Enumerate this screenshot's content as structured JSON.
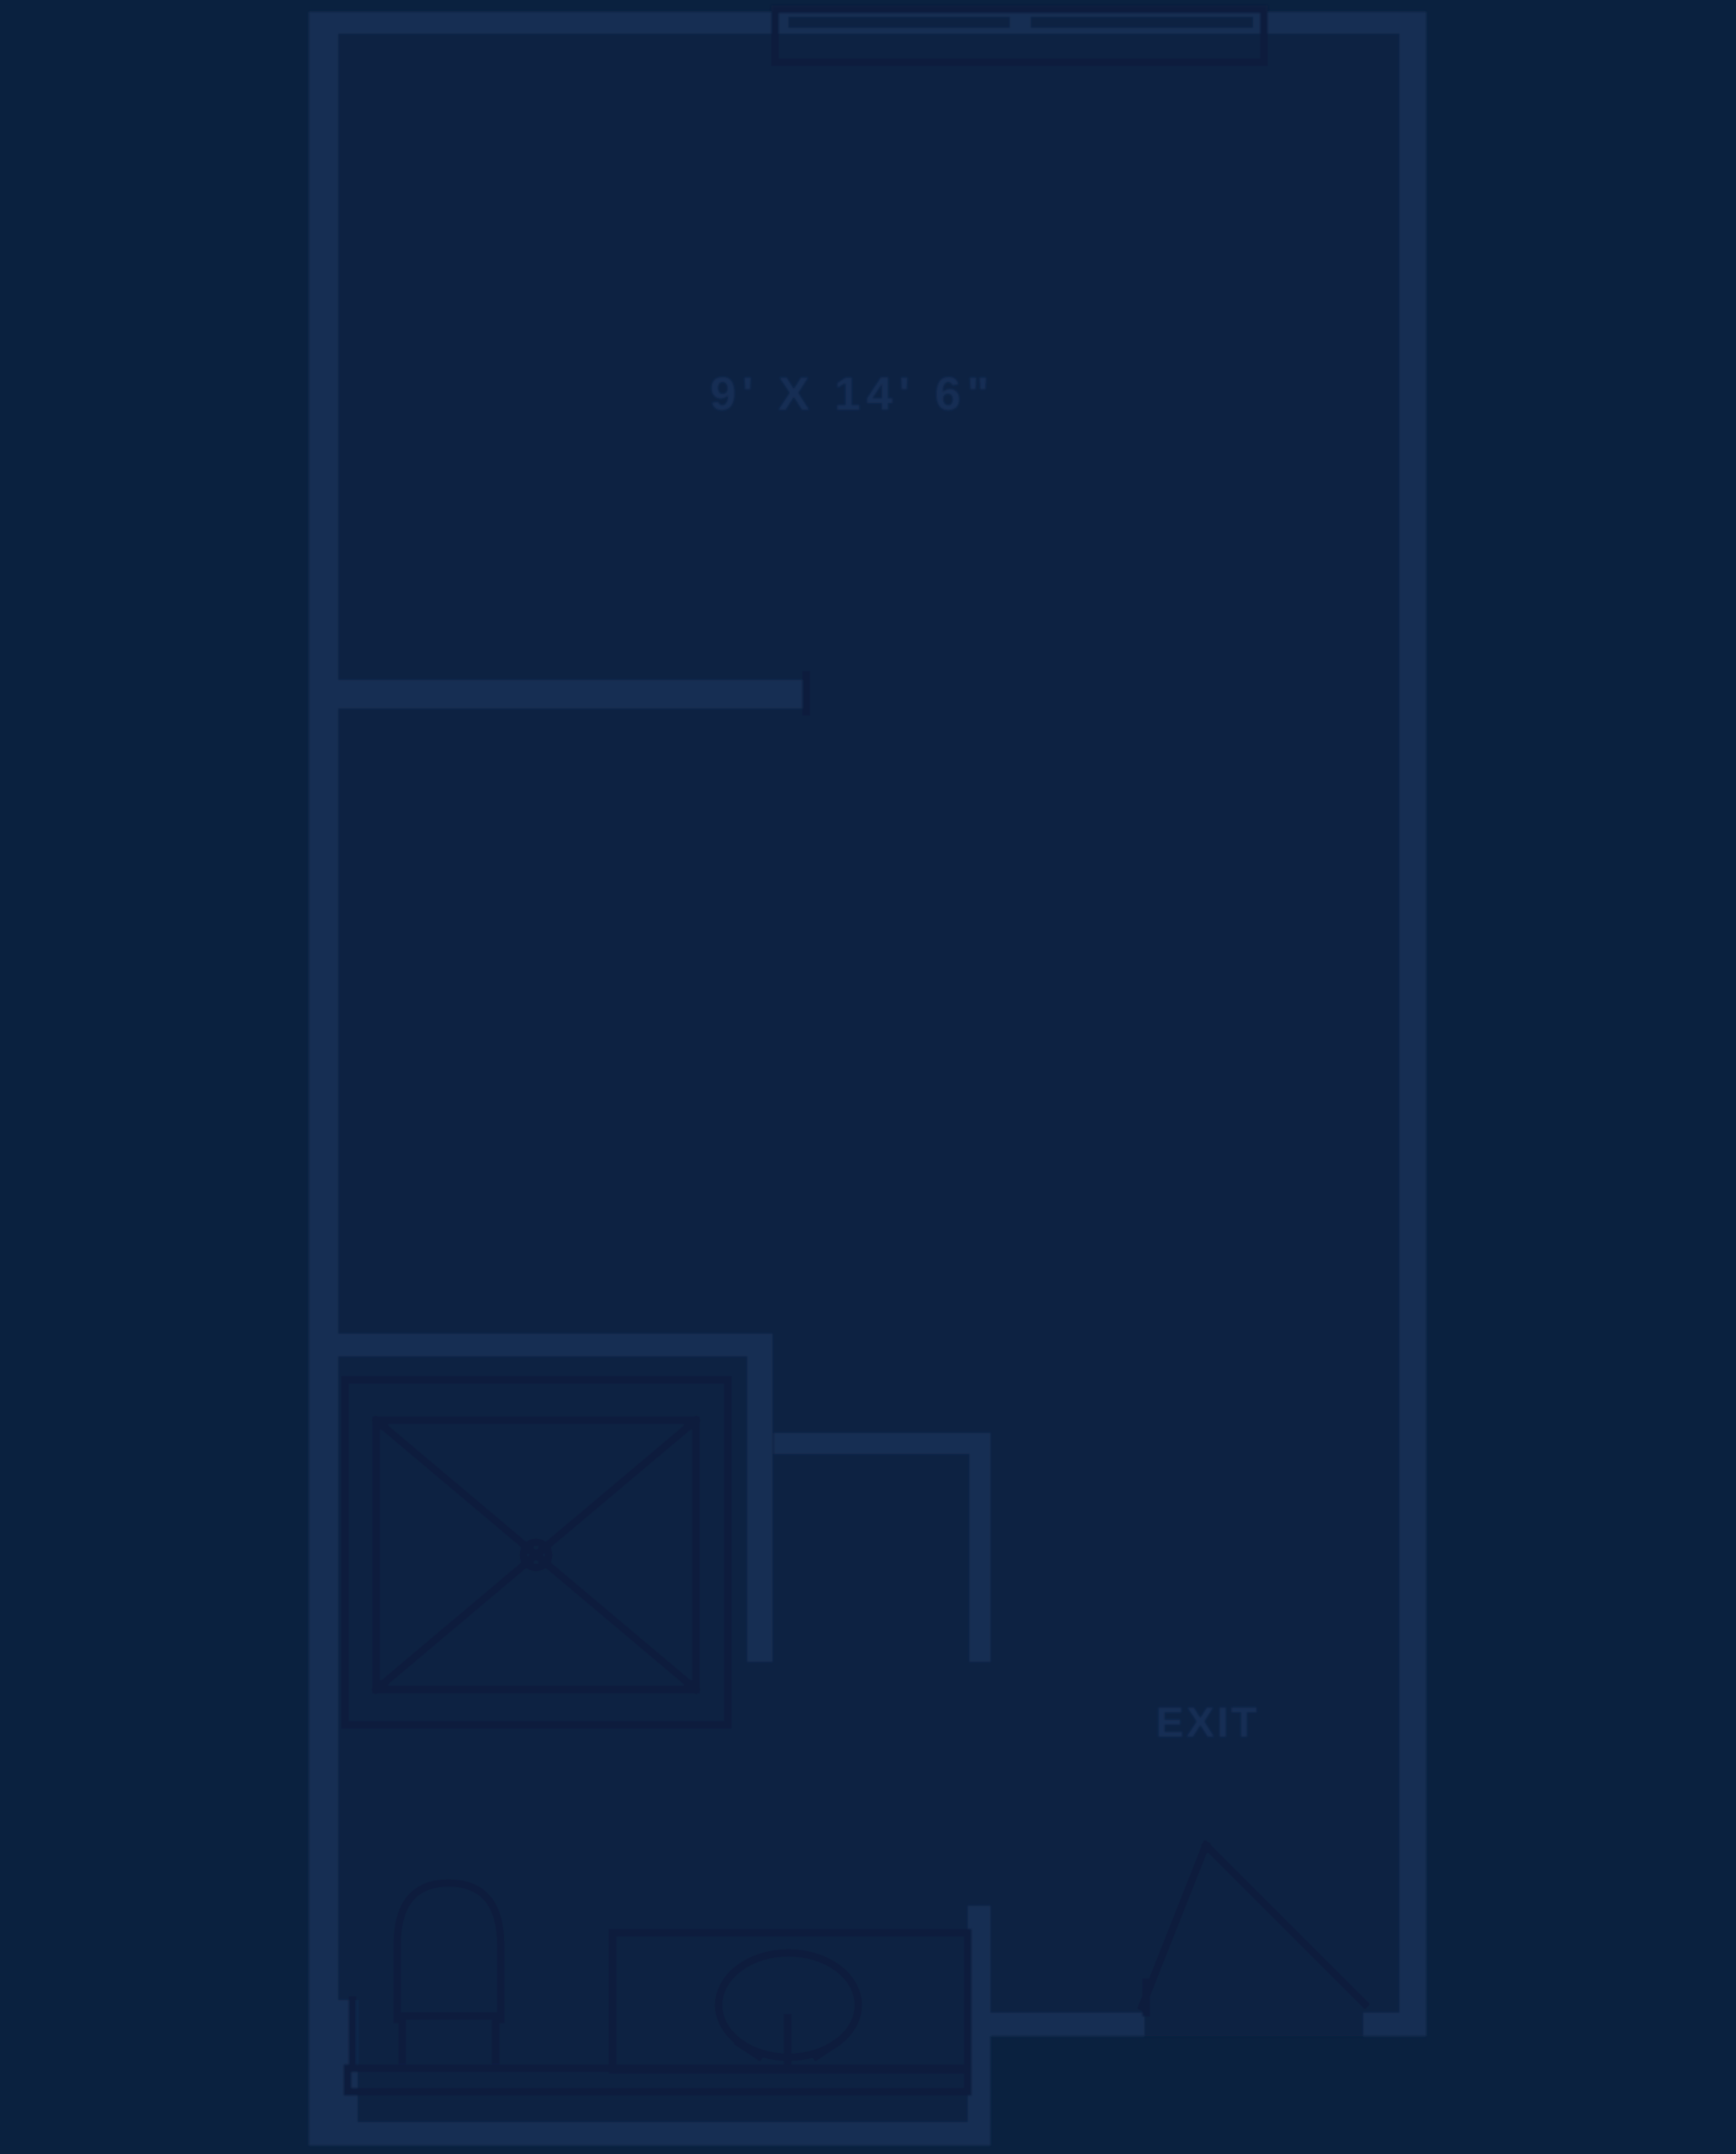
{
  "labels": {
    "room_dimension": "9' X 14' 6\"",
    "exit": "EXIT"
  },
  "colors": {
    "background": "#0A213F",
    "floor": "#0C2443",
    "wall": "#152D52",
    "line": "#081F3C",
    "fixture": "#0A2342",
    "window_bar": "#0B2343",
    "text": "#142E55"
  }
}
